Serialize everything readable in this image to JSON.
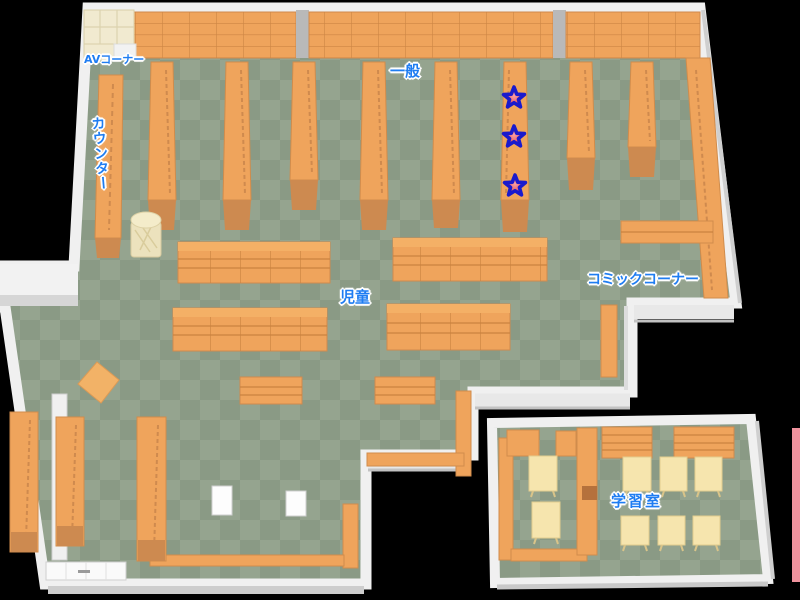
{
  "map_title": "library-floor-map",
  "areas": {
    "av_corner": {
      "label": "AVコーナー"
    },
    "counter": {
      "label": "カウンター"
    },
    "general": {
      "label": "一般"
    },
    "children": {
      "label": "児童"
    },
    "comic_corner": {
      "label": "コミックコーナー"
    },
    "study_room": {
      "label": "学習室"
    }
  },
  "markers": {
    "star_count": 3,
    "located_in_area": "一般",
    "style": {
      "fill": "#e23238",
      "center": "#f8a0a4",
      "outline": "#1a1acd"
    }
  },
  "structures": {
    "general_aisle_shelves": 8,
    "top_wall_shelf_sections": 3,
    "children_low_shelves": 4,
    "children_benches": 2,
    "study_room_tables": 8,
    "bottom_left_shelves": 3
  },
  "palette": {
    "background": "#000000",
    "floor_light": "#95a48f",
    "floor_dark": "#8a9a85",
    "shelf": "#efa45c",
    "shelf_top": "#f4b066",
    "shelf_base": "#cd8a50",
    "shelf_line": "#c9823f",
    "av_shelf_cream": "#f1ead0",
    "table_cream": "#f6e5ae",
    "wall_white": "#f0f0f0",
    "wall_gray": "#c2c2c2",
    "label_blue": "#1f7df2",
    "edge_sliver_pink": "#f0939e"
  }
}
